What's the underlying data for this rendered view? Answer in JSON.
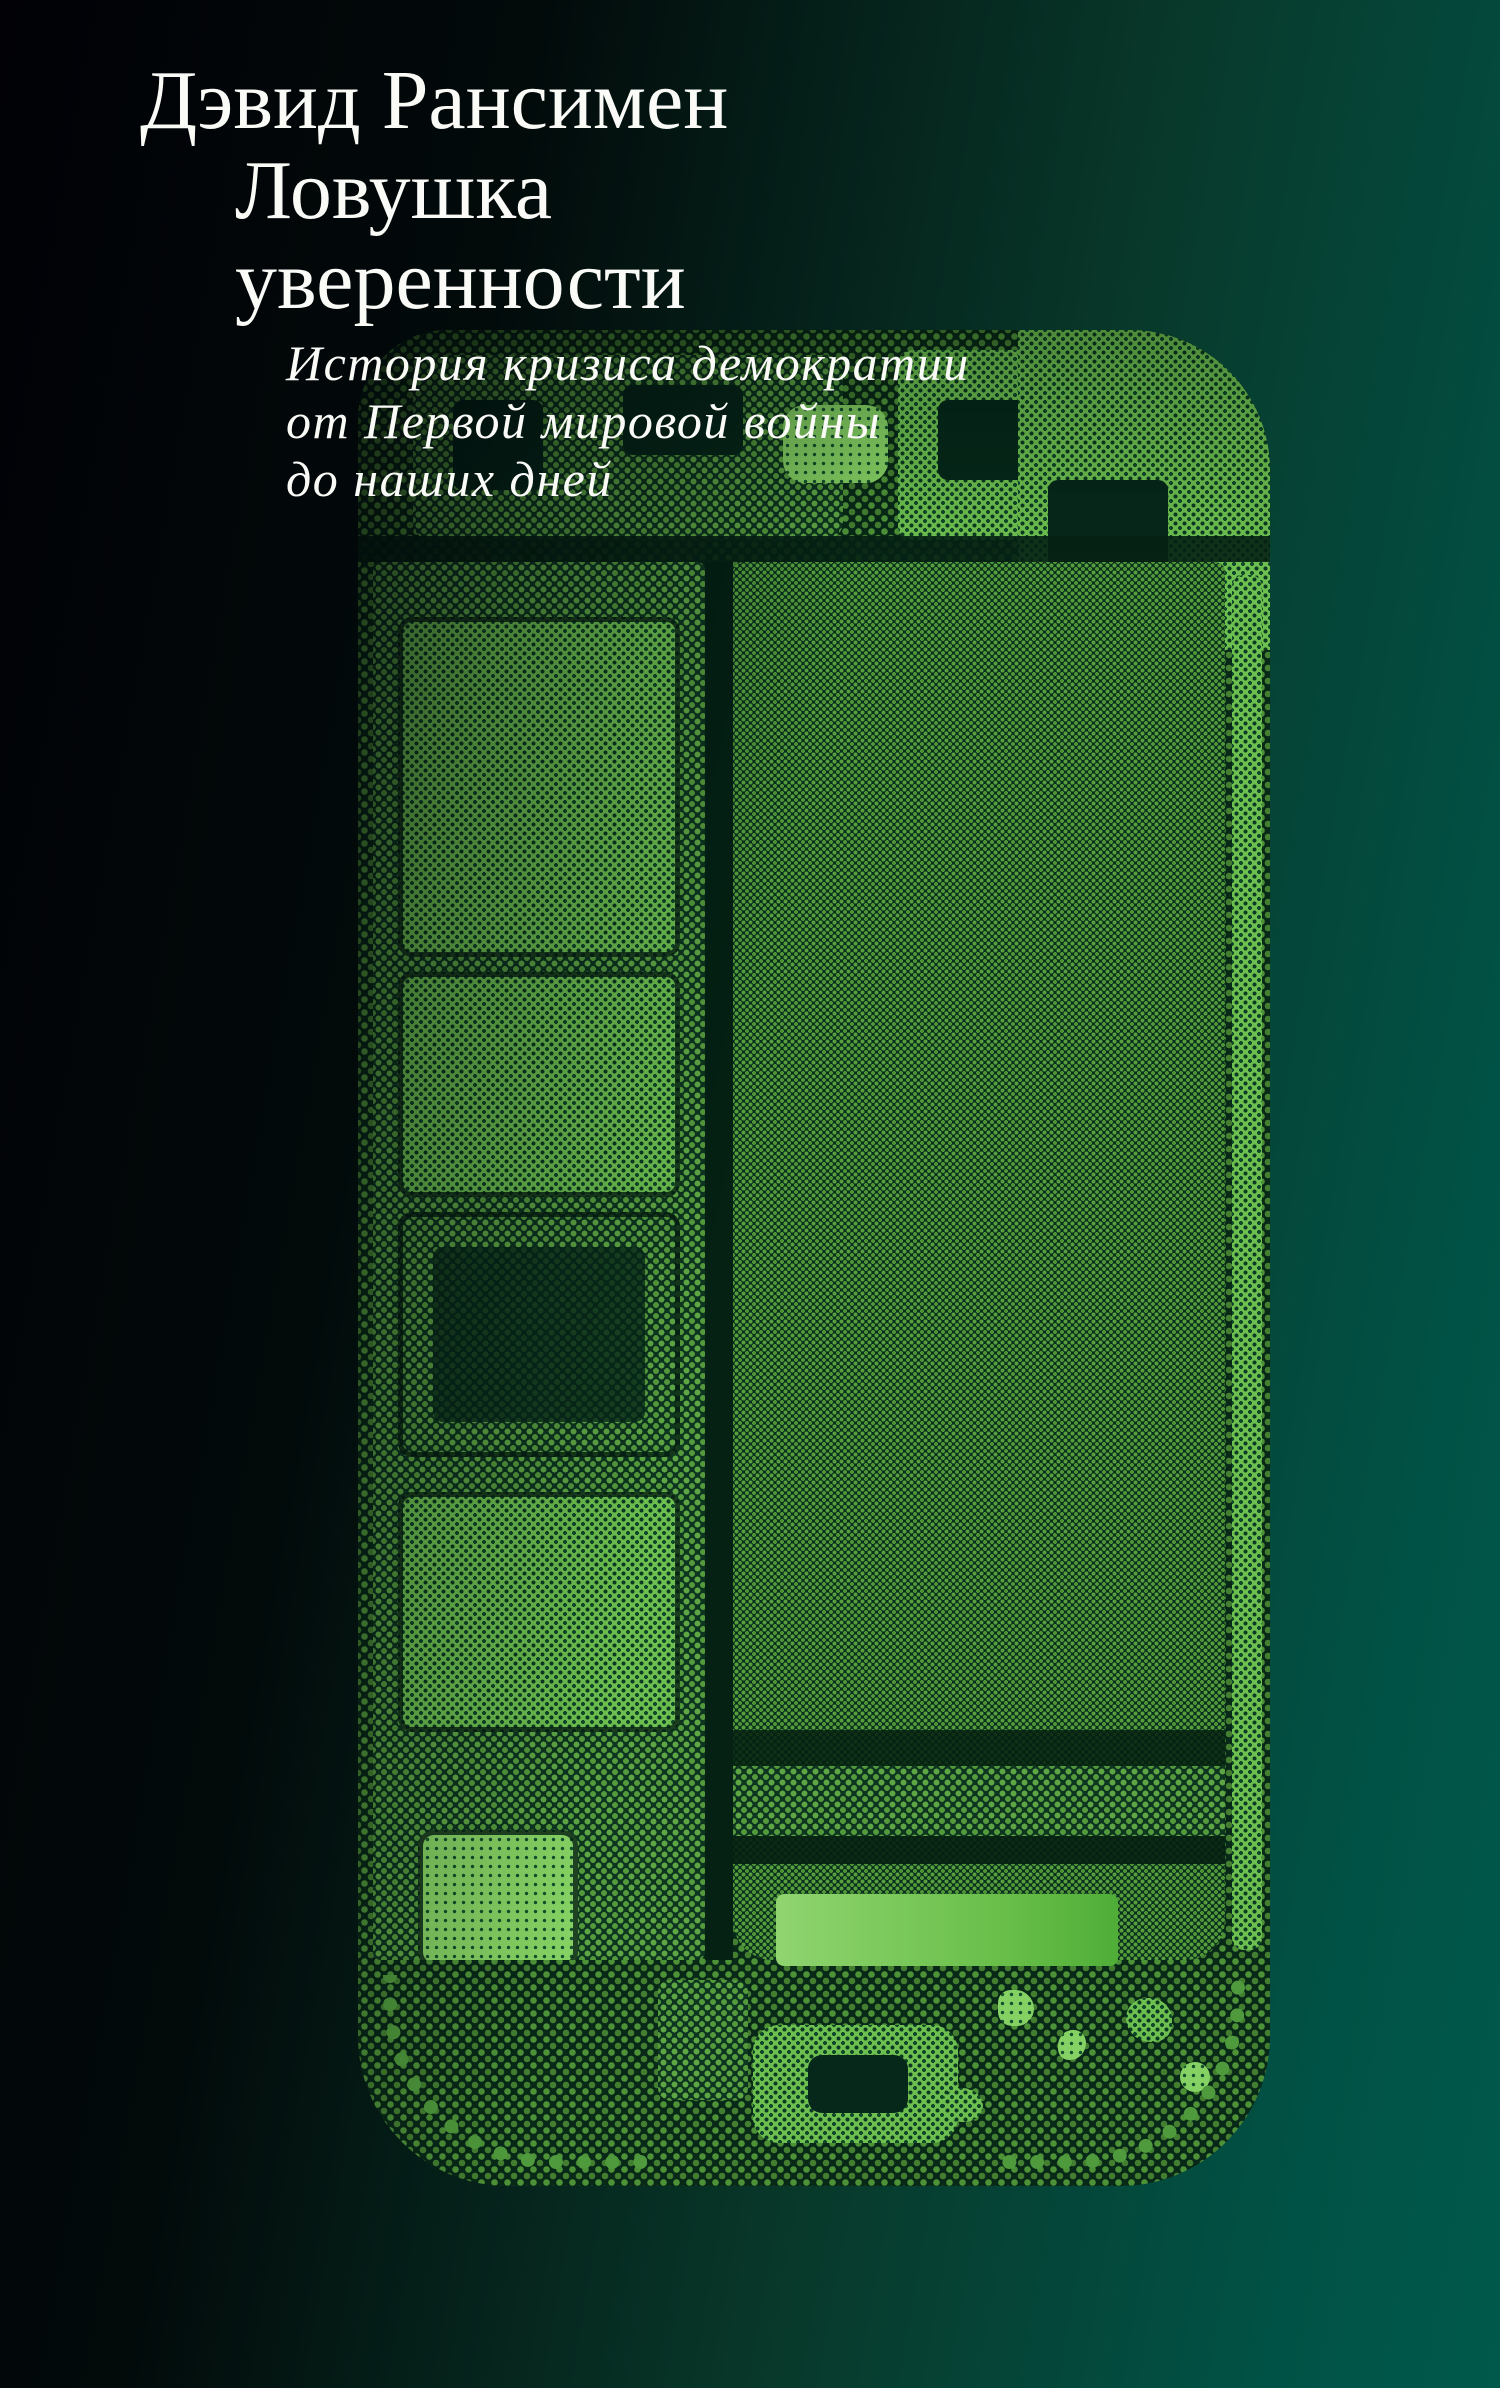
{
  "cover": {
    "author": "Дэвид Рансимен",
    "title_lines": [
      "Ловушка",
      "уверенности"
    ],
    "subtitle_lines": [
      "История кризиса демократии",
      "от Первой мировой войны",
      "до наших дней"
    ]
  },
  "artwork": {
    "subject": "smartphone-internals-halftone",
    "colors": {
      "background_left": "#010106",
      "background_right": "#00594a",
      "halftone_shadow": "#082917",
      "halftone_green": "#55a03d",
      "halftone_bright": "#85d163",
      "bottom_bar_start": "#90d470",
      "bottom_bar_end": "#4fae38",
      "text": "#fafaf7"
    }
  }
}
